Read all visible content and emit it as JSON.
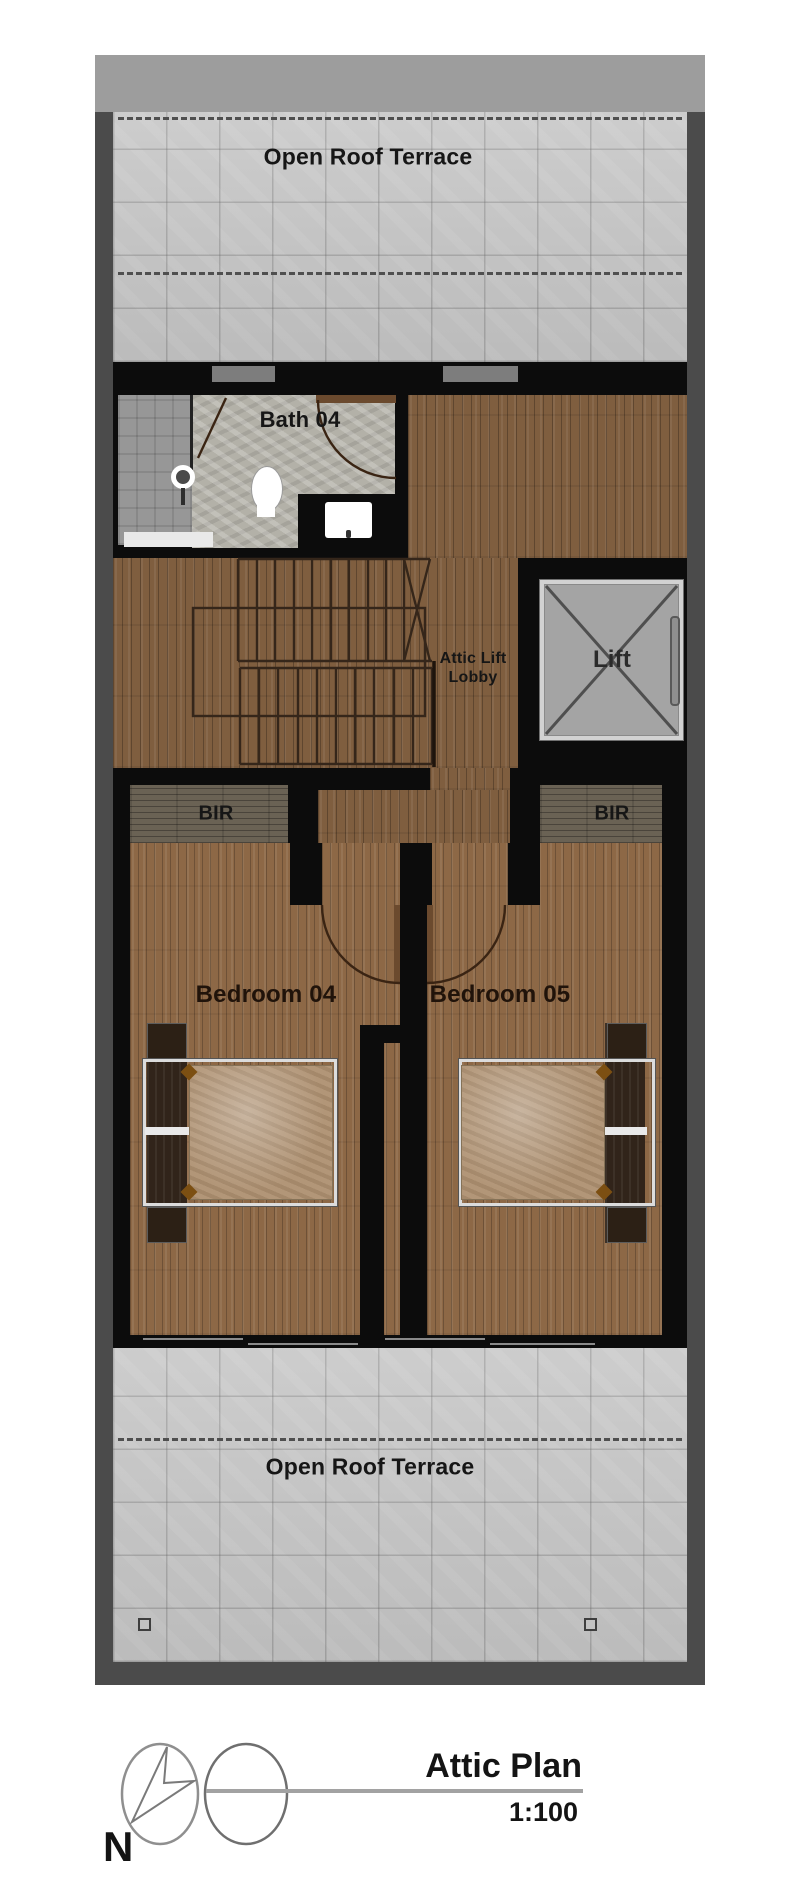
{
  "plan": {
    "terrace_top_label": "Open Roof Terrace",
    "terrace_bottom_label": "Open Roof Terrace",
    "bath_label": "Bath 04",
    "lobby_line1": "Attic Lift",
    "lobby_line2": "Lobby",
    "lift_label": "Lift",
    "bir_left_label": "BIR",
    "bir_right_label": "BIR",
    "bedroom_left_label": "Bedroom 04",
    "bedroom_right_label": "Bedroom 05"
  },
  "legend": {
    "title": "Attic Plan",
    "scale": "1:100",
    "north_label": "N"
  },
  "colors": {
    "interior_wall": "#0c0c0c",
    "outer_wall": "#4b4b4b",
    "parapet": "#9d9d9d",
    "terrace_tile": "#c7c7c7",
    "wood_floor": "#8d6846",
    "lift_fill": "#a4a4a4"
  }
}
